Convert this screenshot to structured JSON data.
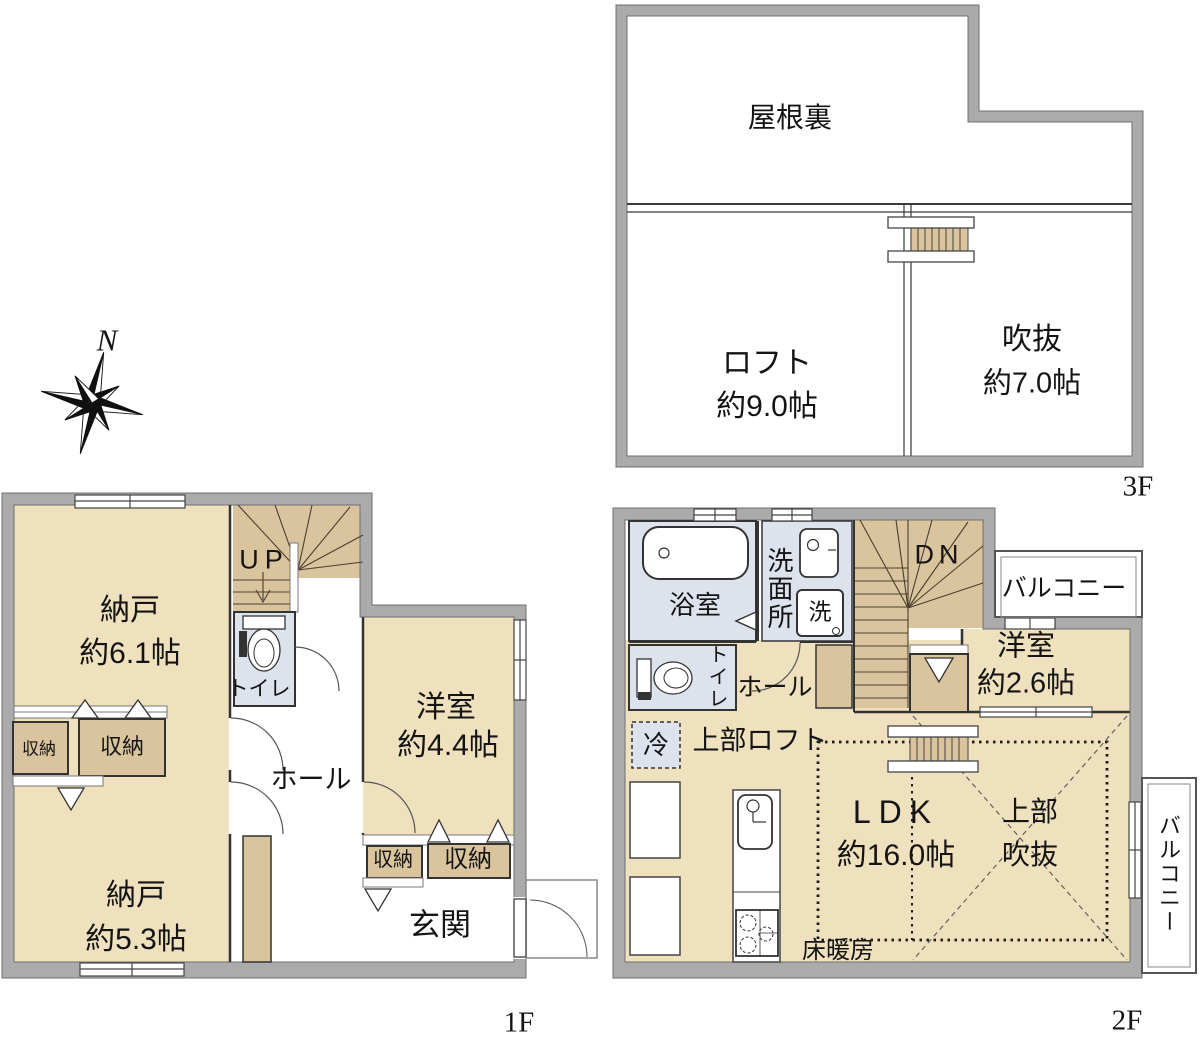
{
  "compass": {
    "north": "N"
  },
  "floor3": {
    "name": "3F",
    "attic": "屋根裏",
    "loft": "ロフト",
    "loft_size": "約9.0帖",
    "void": "吹抜",
    "void_size": "約7.0帖"
  },
  "floor1": {
    "name": "1F",
    "storage_a": "納戸",
    "storage_a_size": "約6.1帖",
    "closet_small": "収納",
    "closet_mid": "収納",
    "storage_b": "納戸",
    "storage_b_size": "約5.3帖",
    "stairs": "UP",
    "toilet": "トイレ",
    "hall": "ホール",
    "bedroom": "洋室",
    "bedroom_size": "約4.4帖",
    "closet_a": "収納",
    "closet_b": "収納",
    "entrance": "玄関"
  },
  "floor2": {
    "name": "2F",
    "bath": "浴室",
    "washroom": "洗面所",
    "washer": "洗",
    "stairs": "DN",
    "balcony_top": "バルコニー",
    "bedroom": "洋室",
    "bedroom_size": "約2.6帖",
    "toilet": "トイレ",
    "hall": "ホール",
    "fridge": "冷",
    "upper_loft": "上部ロフト",
    "ldk": "LDK",
    "ldk_size": "約16.0帖",
    "upper_void_line1": "上部",
    "upper_void_line2": "吹抜",
    "floor_heating": "床暖房",
    "balcony_side": "バルコニー"
  },
  "colors": {
    "wall": "#ababab",
    "floor_tan": "#efe1bd",
    "closet_tan": "#d9c49d",
    "wet_area": "#dde3ed"
  }
}
